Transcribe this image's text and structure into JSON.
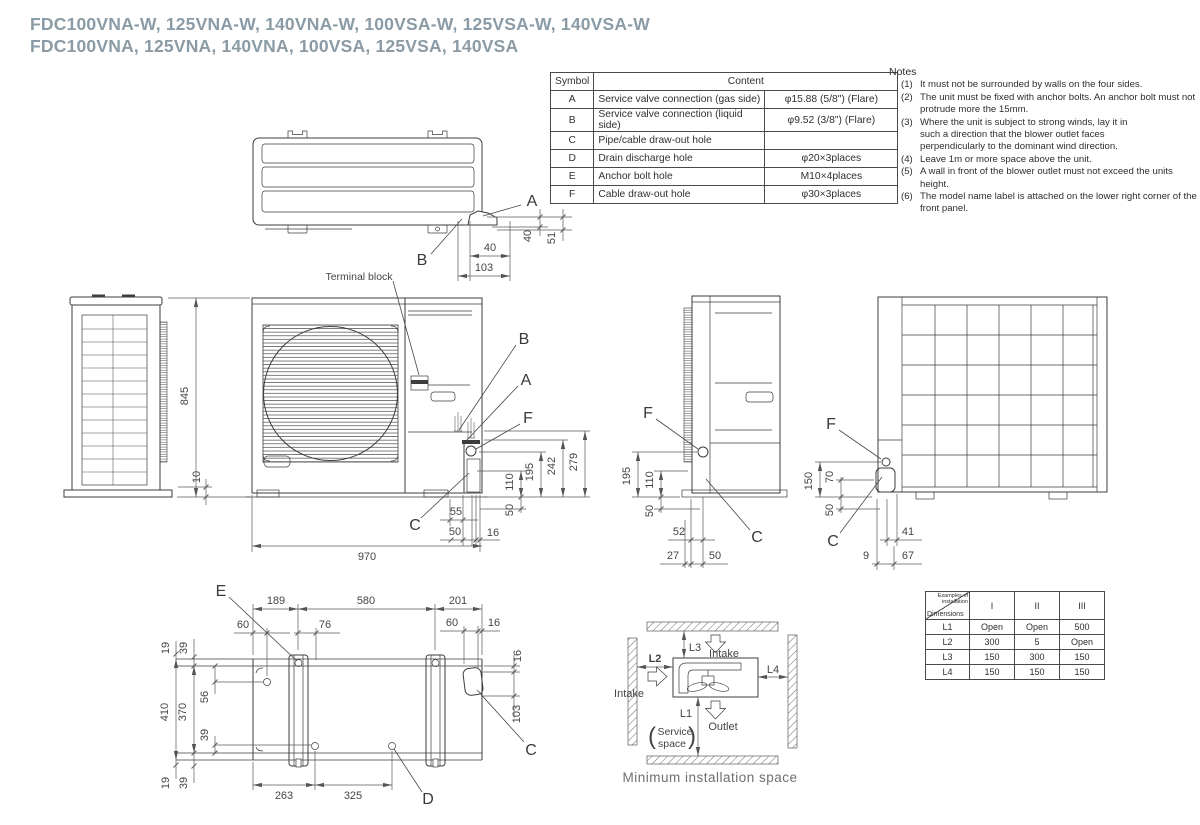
{
  "title": {
    "line1": "FDC100VNA-W, 125VNA-W, 140VNA-W, 100VSA-W, 125VSA-W, 140VSA-W",
    "line2": "FDC100VNA, 125VNA, 140VNA, 100VSA, 125VSA, 140VSA"
  },
  "symbol_table": {
    "header_symbol": "Symbol",
    "header_content": "Content",
    "rows": [
      {
        "symbol": "A",
        "desc": "Service valve connection (gas side)",
        "spec": "φ15.88 (5/8\") (Flare)"
      },
      {
        "symbol": "B",
        "desc": "Service valve connection (liquid side)",
        "spec": "φ9.52 (3/8\") (Flare)"
      },
      {
        "symbol": "C",
        "desc": "Pipe/cable draw-out hole",
        "spec": ""
      },
      {
        "symbol": "D",
        "desc": "Drain discharge hole",
        "spec": "φ20×3places"
      },
      {
        "symbol": "E",
        "desc": "Anchor bolt hole",
        "spec": "M10×4places"
      },
      {
        "symbol": "F",
        "desc": "Cable draw-out hole",
        "spec": "φ30×3places"
      }
    ]
  },
  "notes": {
    "heading": "Notes",
    "items": [
      {
        "num": "(1)",
        "text": "It must not be surrounded by walls on the four sides."
      },
      {
        "num": "(2)",
        "text": "The unit must be fixed with anchor bolts. An anchor bolt must not protrude more the 15mm."
      },
      {
        "num": "(3)",
        "text": "Where the unit is subject to strong winds, lay it in such a direction that the blower outlet faces perpendicularly to the dominant wind direction."
      },
      {
        "num": "(4)",
        "text": "Leave 1m or more space above the unit."
      },
      {
        "num": "(5)",
        "text": "A wall in front of the blower outlet must not exceed the units height."
      },
      {
        "num": "(6)",
        "text": "The model name label is attached on the lower right corner of the front panel."
      }
    ]
  },
  "install_table": {
    "corner_top": "Examples of installation",
    "corner_bottom": "Dimensions",
    "columns": [
      "I",
      "II",
      "III"
    ],
    "rows": [
      {
        "dim": "L1",
        "v1": "Open",
        "v2": "Open",
        "v3": "500"
      },
      {
        "dim": "L2",
        "v1": "300",
        "v2": "5",
        "v3": "Open"
      },
      {
        "dim": "L3",
        "v1": "150",
        "v2": "300",
        "v3": "150"
      },
      {
        "dim": "L4",
        "v1": "150",
        "v2": "150",
        "v3": "150"
      }
    ]
  },
  "min_space": {
    "l1": "L1",
    "l2": "L2",
    "l3": "L3",
    "l4": "L4",
    "intake": "Intake",
    "outlet": "Outlet",
    "service_line1": "Service",
    "service_line2": "space",
    "caption": "Minimum installation space"
  },
  "labels": {
    "terminal_block": "Terminal block",
    "A": "A",
    "B": "B",
    "C": "C",
    "D": "D",
    "E": "E",
    "F": "F",
    "d9": "9",
    "d10": "10",
    "d16": "16",
    "d19": "19",
    "d27": "27",
    "d39": "39",
    "d40": "40",
    "d41": "41",
    "d50": "50",
    "d51": "51",
    "d52": "52",
    "d55": "55",
    "d56": "56",
    "d60": "60",
    "d67": "67",
    "d70": "70",
    "d76": "76",
    "d103": "103",
    "d110": "110",
    "d150": "150",
    "d189": "189",
    "d195": "195",
    "d201": "201",
    "d242": "242",
    "d263": "263",
    "d279": "279",
    "d325": "325",
    "d370": "370",
    "d410": "410",
    "d580": "580",
    "d845": "845",
    "d970": "970"
  },
  "colors": {
    "title": "#8a9ba6",
    "line": "#3d3d3d",
    "dim_text": "#454545",
    "caption": "#6e6e6e"
  }
}
